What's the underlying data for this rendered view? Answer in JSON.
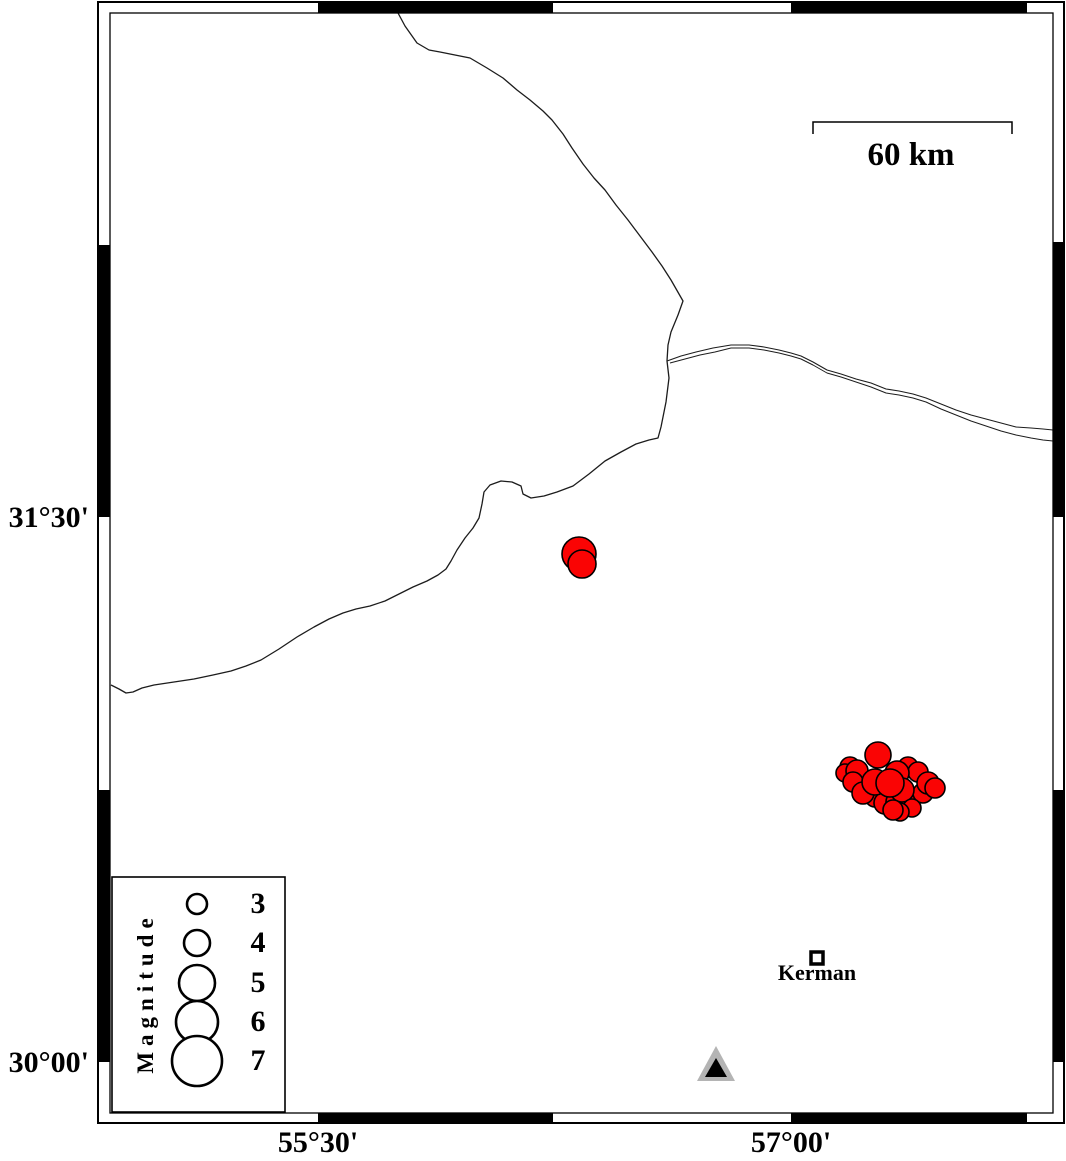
{
  "figure": {
    "type": "seismicity-map",
    "scalebar": {
      "label": "60 km",
      "x1": 813,
      "x2": 1012,
      "y": 122,
      "tick_len": 12
    },
    "city": {
      "label": "Kerman",
      "x": 817,
      "y": 958,
      "size": 12
    },
    "legend": {
      "title": "Magnitude",
      "box": {
        "x": 112,
        "y": 877,
        "w": 173,
        "h": 235
      },
      "circle_x": 197,
      "label_x": 258,
      "entries": [
        {
          "mag": "3",
          "y": 904,
          "r": 10
        },
        {
          "mag": "4",
          "y": 943,
          "r": 13
        },
        {
          "mag": "5",
          "y": 983,
          "r": 18
        },
        {
          "mag": "6",
          "y": 1022,
          "r": 21
        },
        {
          "mag": "7",
          "y": 1061,
          "r": 25
        }
      ]
    },
    "axes": {
      "left": [
        {
          "label": "31°30'",
          "y": 517
        },
        {
          "label": "30°00'",
          "y": 1062
        }
      ],
      "bottom": [
        {
          "label": "55°30'",
          "x": 318
        },
        {
          "label": "57°00'",
          "x": 791
        }
      ]
    },
    "frame": {
      "outer": {
        "x": 98,
        "y": 2,
        "w": 966,
        "h": 1121
      },
      "inner": {
        "x": 110,
        "y": 13,
        "w": 943,
        "h": 1100
      },
      "black_top": [
        [
          318,
          553
        ],
        [
          791,
          1027
        ]
      ],
      "black_bottom": [
        [
          318,
          553
        ],
        [
          791,
          1027
        ]
      ],
      "black_left": [
        [
          245,
          517
        ],
        [
          790,
          1062
        ]
      ],
      "black_right": [
        [
          242,
          517
        ],
        [
          790,
          1062
        ]
      ]
    },
    "colors": {
      "earthquake_fill": "#fa0404",
      "line": "#1c1c1c",
      "station_gray": "#b4b4b4",
      "black": "#000000",
      "white": "#ffffff"
    },
    "station_triangle": {
      "outer": [
        [
          716,
          1046
        ],
        [
          697,
          1081
        ],
        [
          735,
          1081
        ]
      ],
      "inner": [
        [
          716,
          1058
        ],
        [
          705,
          1077
        ],
        [
          727,
          1077
        ]
      ]
    },
    "faults": [
      {
        "name": "fault-main",
        "width": 1.3,
        "points": [
          [
            398,
            13
          ],
          [
            405,
            26
          ],
          [
            417,
            43
          ],
          [
            429,
            50
          ],
          [
            440,
            52
          ],
          [
            455,
            55
          ],
          [
            470,
            58
          ],
          [
            487,
            68
          ],
          [
            503,
            78
          ],
          [
            517,
            90
          ],
          [
            530,
            100
          ],
          [
            543,
            111
          ],
          [
            552,
            120
          ],
          [
            563,
            134
          ],
          [
            572,
            148
          ],
          [
            583,
            164
          ],
          [
            594,
            178
          ],
          [
            605,
            190
          ],
          [
            616,
            205
          ],
          [
            628,
            220
          ],
          [
            640,
            236
          ],
          [
            652,
            252
          ],
          [
            662,
            266
          ],
          [
            671,
            280
          ],
          [
            679,
            294
          ],
          [
            683,
            301
          ],
          [
            678,
            315
          ],
          [
            671,
            332
          ],
          [
            668,
            345
          ],
          [
            667,
            361
          ],
          [
            669,
            378
          ],
          [
            666,
            402
          ],
          [
            661,
            427
          ],
          [
            658,
            438
          ],
          [
            649,
            440
          ],
          [
            636,
            444
          ],
          [
            621,
            452
          ],
          [
            605,
            461
          ],
          [
            589,
            474
          ],
          [
            573,
            486
          ],
          [
            557,
            492
          ],
          [
            544,
            496
          ],
          [
            531,
            498
          ],
          [
            523,
            494
          ],
          [
            521,
            486
          ],
          [
            512,
            482
          ],
          [
            501,
            481
          ],
          [
            490,
            485
          ],
          [
            484,
            492
          ],
          [
            482,
            504
          ],
          [
            479,
            518
          ],
          [
            473,
            528
          ],
          [
            465,
            538
          ],
          [
            457,
            550
          ],
          [
            451,
            561
          ],
          [
            446,
            569
          ],
          [
            438,
            575
          ],
          [
            427,
            581
          ],
          [
            413,
            587
          ],
          [
            399,
            594
          ],
          [
            385,
            601
          ],
          [
            370,
            606
          ],
          [
            356,
            609
          ],
          [
            343,
            613
          ],
          [
            329,
            619
          ],
          [
            314,
            627
          ],
          [
            297,
            637
          ],
          [
            279,
            649
          ],
          [
            261,
            660
          ],
          [
            246,
            666
          ],
          [
            231,
            671
          ],
          [
            213,
            675
          ],
          [
            194,
            679
          ],
          [
            174,
            682
          ],
          [
            154,
            685
          ],
          [
            142,
            688
          ],
          [
            133,
            692
          ],
          [
            126,
            693
          ],
          [
            119,
            689
          ],
          [
            111,
            685
          ]
        ]
      },
      {
        "name": "fault-branch-a",
        "width": 1.1,
        "points": [
          [
            667,
            361
          ],
          [
            681,
            356
          ],
          [
            696,
            352
          ],
          [
            713,
            348
          ],
          [
            731,
            345
          ],
          [
            749,
            345
          ],
          [
            764,
            347
          ],
          [
            779,
            350
          ],
          [
            791,
            353
          ],
          [
            801,
            356
          ],
          [
            813,
            362
          ],
          [
            827,
            370
          ],
          [
            841,
            374
          ],
          [
            856,
            379
          ],
          [
            871,
            383
          ],
          [
            886,
            389
          ],
          [
            899,
            391
          ],
          [
            913,
            394
          ],
          [
            926,
            398
          ],
          [
            941,
            404
          ],
          [
            956,
            410
          ],
          [
            971,
            415
          ],
          [
            986,
            419
          ],
          [
            1001,
            423
          ],
          [
            1016,
            427
          ],
          [
            1031,
            428
          ],
          [
            1043,
            429
          ],
          [
            1053,
            430
          ]
        ]
      },
      {
        "name": "fault-branch-b",
        "width": 1.0,
        "points": [
          [
            670,
            363
          ],
          [
            685,
            359
          ],
          [
            700,
            355
          ],
          [
            715,
            352
          ],
          [
            731,
            348
          ],
          [
            749,
            348
          ],
          [
            764,
            350
          ],
          [
            779,
            353
          ],
          [
            791,
            356
          ],
          [
            801,
            359
          ],
          [
            813,
            365
          ],
          [
            827,
            373
          ],
          [
            841,
            377
          ],
          [
            856,
            382
          ],
          [
            871,
            387
          ],
          [
            886,
            393
          ],
          [
            899,
            395
          ],
          [
            913,
            398
          ],
          [
            926,
            402
          ],
          [
            941,
            409
          ],
          [
            956,
            415
          ],
          [
            971,
            421
          ],
          [
            986,
            426
          ],
          [
            1001,
            431
          ],
          [
            1016,
            435
          ],
          [
            1031,
            438
          ],
          [
            1043,
            440
          ],
          [
            1053,
            441
          ]
        ]
      }
    ],
    "earthquakes": [
      [
        850,
        767,
        10
      ],
      [
        845,
        773,
        9
      ],
      [
        857,
        771,
        11
      ],
      [
        853,
        782,
        10
      ],
      [
        908,
        767,
        10
      ],
      [
        918,
        772,
        10
      ],
      [
        897,
        773,
        12
      ],
      [
        867,
        792,
        11
      ],
      [
        875,
        797,
        10
      ],
      [
        863,
        793,
        11
      ],
      [
        885,
        803,
        11
      ],
      [
        897,
        802,
        11
      ],
      [
        910,
        798,
        11
      ],
      [
        923,
        793,
        10
      ],
      [
        928,
        783,
        11
      ],
      [
        935,
        788,
        10
      ],
      [
        902,
        790,
        12
      ],
      [
        912,
        808,
        9
      ],
      [
        900,
        812,
        9
      ],
      [
        893,
        810,
        10
      ],
      [
        875,
        782,
        13
      ],
      [
        890,
        783,
        14
      ],
      [
        878,
        755,
        13
      ],
      [
        579,
        554,
        17
      ],
      [
        582,
        564,
        14
      ]
    ]
  }
}
